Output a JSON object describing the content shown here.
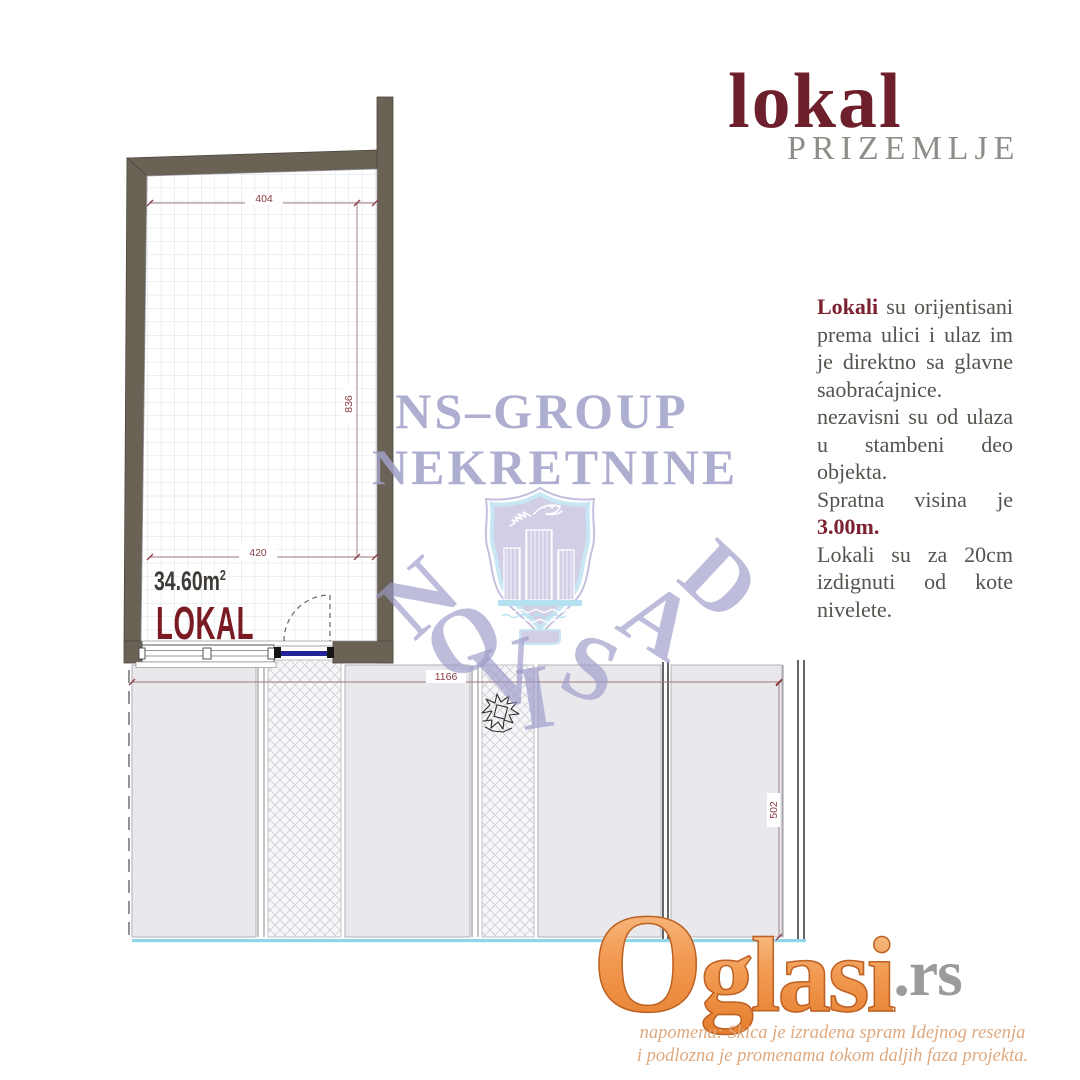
{
  "header": {
    "title": "lokal",
    "subtitle": "PRIZEMLJE"
  },
  "info": {
    "p1_lead": "Lokali",
    "p1_rest": "su orijentisani prema ulici i ulaz im je direktno sa glavne saobraćajnice. nezavisni su od ulaza u stambeni deo objekta.",
    "p2_text": "Spratna visina je",
    "p2_value": "3.00m.",
    "p3_text": "Lokali su za 20cm izdignuti od kote nivelete."
  },
  "plan": {
    "room_label": "LOKAL",
    "area": "34.60m",
    "area_exp": "2",
    "dim_top": "404",
    "dim_side": "836",
    "dim_bottom": "420",
    "dim_walk_width": "1166",
    "dim_walk_depth": "502"
  },
  "watermark": {
    "agency_line1": "NS–GROUP",
    "agency_line2": "NEKRETNINE",
    "city": [
      "N",
      "O",
      "V",
      "I",
      "S",
      "A",
      "D"
    ]
  },
  "footer": {
    "brand": "Oglasi",
    "brand_suffix": ".rs",
    "note1": "napomena: Skica je izradena spram Idejnog resenja",
    "note2": "i podlozna je promenama tokom daljih faza projekta."
  },
  "colors": {
    "maroon": "#7a2030",
    "wall": "#6a6355",
    "watermark_lavender": "#b1b1d1",
    "brand_orange": "#ee9348",
    "note_tan": "#dfa87d",
    "water_cyan": "#8fd6e8"
  }
}
